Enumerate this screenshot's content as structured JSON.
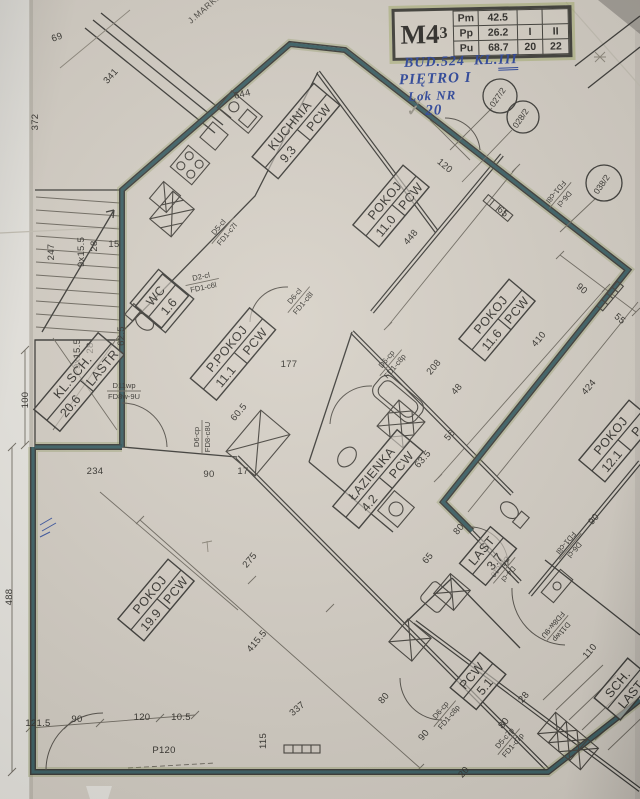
{
  "title_block": {
    "unit": "M4",
    "unit_sub": "3",
    "rows": [
      {
        "label": "Pm",
        "value": "42.5",
        "c1": "",
        "c2": ""
      },
      {
        "label": "Pp",
        "value": "26.2",
        "c1": "I",
        "c2": "II"
      },
      {
        "label": "Pu",
        "value": "68.7",
        "c1": "20",
        "c2": "22"
      }
    ]
  },
  "notes": {
    "building": "BUD.524",
    "klatka": "KL.",
    "klatka_no": "III",
    "floor": "PIĘTRO I",
    "lok": "Lok NR",
    "lok_no": "20",
    "check": "✓"
  },
  "street": "J.MARKI GŁĘBOCKU",
  "circles": [
    {
      "t": "027/2",
      "x": 500,
      "y": 96,
      "rr": 17
    },
    {
      "t": "028/2",
      "x": 523,
      "y": 117,
      "rr": 16
    },
    {
      "t": "038/2",
      "x": 604,
      "y": 183,
      "rr": 18
    }
  ],
  "rooms": [
    {
      "name": "KUCHNIA",
      "area": "9.3",
      "floor": "PCW",
      "x": 296,
      "y": 131,
      "r": -50,
      "w": 96
    },
    {
      "name": "POKOJ",
      "area": "11.0",
      "floor": "PCW",
      "x": 391,
      "y": 206,
      "r": -50,
      "w": 78
    },
    {
      "name": "POKOJ",
      "area": "11.6",
      "floor": "PCW",
      "x": 497,
      "y": 320,
      "r": -50,
      "w": 78
    },
    {
      "name": "P.POKOJ",
      "area": "11.1",
      "floor": "PCW",
      "x": 233,
      "y": 354,
      "r": -50,
      "w": 92
    },
    {
      "name": "WC",
      "area": "1.6",
      "x": 162,
      "y": 301,
      "r": -50,
      "w": 42
    },
    {
      "name": "KL.SCH.",
      "area": "20.6",
      "floor": "LASTR",
      "x": 79,
      "y": 382,
      "r": -50,
      "w": 100
    },
    {
      "name": "ŁAZIENKA",
      "area": "4.2",
      "floor": "PCW",
      "x": 378,
      "y": 479,
      "r": -50,
      "w": 100
    },
    {
      "name": "POKOJ",
      "area": "19.9",
      "floor": "PCW",
      "x": 156,
      "y": 600,
      "r": -50,
      "w": 78
    },
    {
      "name": "POKOJ",
      "area": "12.1",
      "floor": "P",
      "x": 617,
      "y": 441,
      "r": -50,
      "w": 78
    },
    {
      "name": "LAST",
      "area": "3.7",
      "x": 488,
      "y": 556,
      "r": -50,
      "w": 48
    },
    {
      "name": "PCW",
      "area": "5.1",
      "x": 478,
      "y": 681,
      "r": -50,
      "w": 46
    },
    {
      "name": "SCH.",
      "area": "LAST",
      "x": 624,
      "y": 689,
      "r": -50,
      "w": 52
    }
  ],
  "door_labels": [
    {
      "l1": "D5-cl",
      "l2": "FD1-c7l",
      "x": 222,
      "y": 230,
      "r": -50
    },
    {
      "l1": "D2-cl",
      "l2": "FD1-c6l",
      "x": 202,
      "y": 281,
      "r": -12
    },
    {
      "l1": "D6-cl",
      "l2": "FD1-c8l",
      "x": 298,
      "y": 299,
      "r": -50
    },
    {
      "l1": "D6-cp",
      "l2": "FD1-c8p",
      "x": 390,
      "y": 362,
      "r": -50
    },
    {
      "l1": "D11wp",
      "l2": "FD8w-9U",
      "x": 124,
      "y": 390,
      "r": 0
    },
    {
      "l1": "D6-cp",
      "l2": "FD8-c8U",
      "x": 201,
      "y": 437,
      "r": -90
    },
    {
      "l1": "D6-cl",
      "l2": "FD1-c8l",
      "x": 561,
      "y": 196,
      "r": 130
    },
    {
      "l1": "D6-cl",
      "l2": "FD1-c8l",
      "x": 571,
      "y": 547,
      "r": 130
    },
    {
      "l1": "D4-cl",
      "l2": "D5-c10",
      "x": 505,
      "y": 571,
      "r": 130
    },
    {
      "l1": "D11wp",
      "l2": "FD8w-9U",
      "x": 558,
      "y": 629,
      "r": 130
    },
    {
      "l1": "D6-cp",
      "l2": "FD1-c8p",
      "x": 444,
      "y": 713,
      "r": -50
    },
    {
      "l1": "D5-c7p",
      "l2": "FD1-c7p",
      "x": 508,
      "y": 741,
      "r": -50
    }
  ],
  "dimensions": [
    {
      "t": "372",
      "x": 38,
      "y": 122,
      "r": -90
    },
    {
      "t": "69",
      "x": 58,
      "y": 40,
      "r": -20
    },
    {
      "t": "341",
      "x": 113,
      "y": 78,
      "r": -48
    },
    {
      "t": "644",
      "x": 243,
      "y": 97,
      "r": -14
    },
    {
      "t": "120",
      "x": 443,
      "y": 168,
      "r": 40
    },
    {
      "t": "65",
      "x": 501,
      "y": 214,
      "r": 40
    },
    {
      "t": "90",
      "x": 580,
      "y": 291,
      "r": 40
    },
    {
      "t": "55",
      "x": 618,
      "y": 321,
      "r": 40
    },
    {
      "t": "448",
      "x": 413,
      "y": 239,
      "r": -50
    },
    {
      "t": "410",
      "x": 541,
      "y": 341,
      "r": -50
    },
    {
      "t": "424",
      "x": 591,
      "y": 389,
      "r": -50
    },
    {
      "t": "208",
      "x": 436,
      "y": 369,
      "r": -50
    },
    {
      "t": "48",
      "x": 459,
      "y": 391,
      "r": -50
    },
    {
      "t": "9x15.5",
      "x": 84,
      "y": 252,
      "r": -90
    },
    {
      "t": "28",
      "x": 97,
      "y": 246,
      "r": -90
    },
    {
      "t": "9x15.5",
      "x": 80,
      "y": 354,
      "r": -90
    },
    {
      "t": "28",
      "x": 93,
      "y": 348,
      "r": -90
    },
    {
      "t": "247",
      "x": 54,
      "y": 252,
      "r": -90
    },
    {
      "t": "15",
      "x": 114,
      "y": 247,
      "r": 0
    },
    {
      "t": "62.5",
      "x": 124,
      "y": 336,
      "r": -90
    },
    {
      "t": "100",
      "x": 28,
      "y": 400,
      "r": -90
    },
    {
      "t": "177",
      "x": 289,
      "y": 367,
      "r": 0
    },
    {
      "t": "60.5",
      "x": 241,
      "y": 414,
      "r": -50
    },
    {
      "t": "90",
      "x": 209,
      "y": 477,
      "r": 0
    },
    {
      "t": "17",
      "x": 243,
      "y": 474,
      "r": 0
    },
    {
      "t": "234",
      "x": 95,
      "y": 474,
      "r": 0
    },
    {
      "t": "56",
      "x": 452,
      "y": 437,
      "r": -50
    },
    {
      "t": "63.5",
      "x": 425,
      "y": 461,
      "r": -50
    },
    {
      "t": "65",
      "x": 430,
      "y": 560,
      "r": -50
    },
    {
      "t": "80",
      "x": 461,
      "y": 531,
      "r": -50
    },
    {
      "t": "90",
      "x": 596,
      "y": 521,
      "r": -50
    },
    {
      "t": "275",
      "x": 252,
      "y": 562,
      "r": -50
    },
    {
      "t": "415.5",
      "x": 259,
      "y": 643,
      "r": -50
    },
    {
      "t": "488",
      "x": 12,
      "y": 597,
      "r": -90
    },
    {
      "t": "121.5",
      "x": 38,
      "y": 726,
      "r": 0
    },
    {
      "t": "90",
      "x": 77,
      "y": 722,
      "r": 0
    },
    {
      "t": "120",
      "x": 142,
      "y": 720,
      "r": 0
    },
    {
      "t": "10.5",
      "x": 181,
      "y": 720,
      "r": 0
    },
    {
      "t": "P120",
      "x": 164,
      "y": 753,
      "r": 0
    },
    {
      "t": "115",
      "x": 266,
      "y": 741,
      "r": -90
    },
    {
      "t": "337",
      "x": 299,
      "y": 711,
      "r": -40
    },
    {
      "t": "80",
      "x": 386,
      "y": 700,
      "r": -50
    },
    {
      "t": "90",
      "x": 426,
      "y": 737,
      "r": -50
    },
    {
      "t": "110",
      "x": 592,
      "y": 653,
      "r": -50
    },
    {
      "t": "28",
      "x": 526,
      "y": 699,
      "r": -50
    },
    {
      "t": "80",
      "x": 506,
      "y": 725,
      "r": -50
    },
    {
      "t": "20",
      "x": 466,
      "y": 774,
      "r": -50
    }
  ],
  "colors": {
    "paper": "#d6d0c6",
    "ink": "#3b3a36",
    "marker_teal": "#2e565c",
    "marker_olive": "#8a9456",
    "pen_blue": "#2b459c"
  }
}
